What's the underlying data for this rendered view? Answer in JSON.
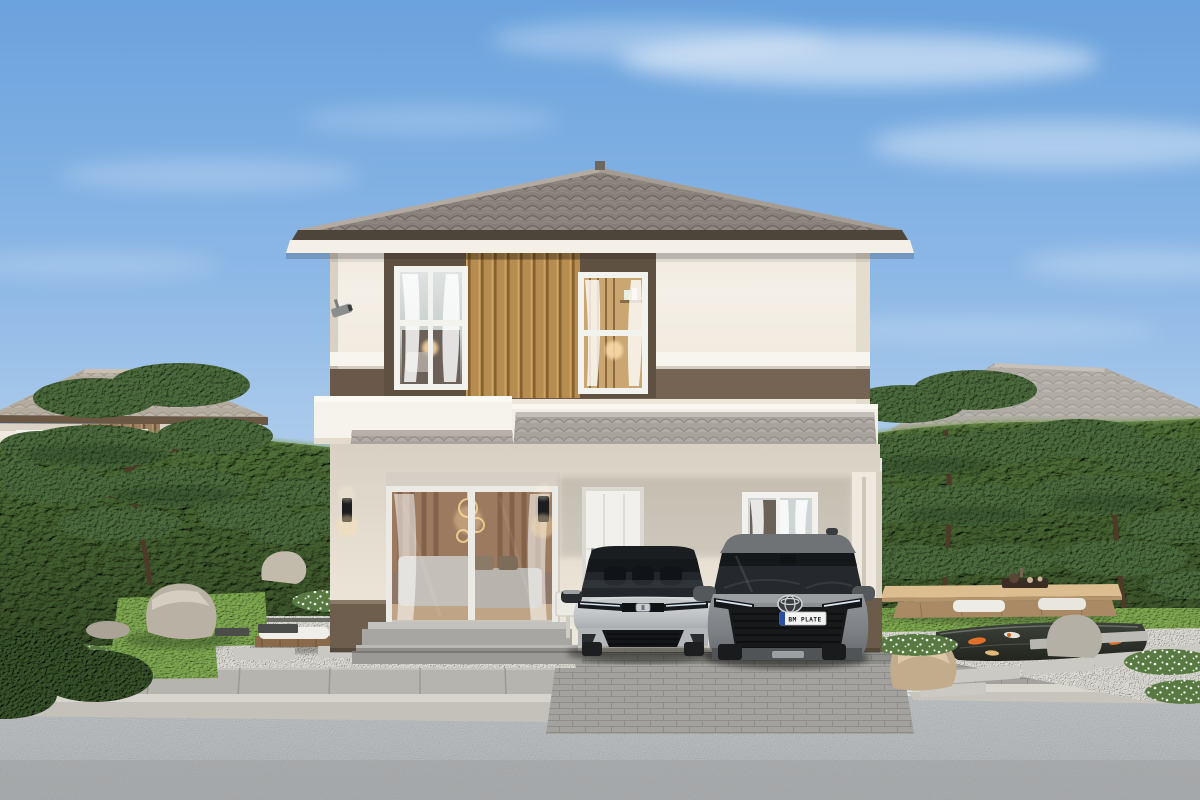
{
  "meta": {
    "title": "Photorealistic exterior rendering of a two-storey house at dusk",
    "view": "street-front elevation"
  },
  "palette": {
    "sky_top": "#6aa2dd",
    "sky_horizon": "#e9f1f7",
    "roof_tile": "#8f8881",
    "awning_tile": "#a8a39c",
    "fascia_dark": "#4a3f33",
    "wall_cream": "#f3eee5",
    "accent_brown_band": "#6a594a",
    "wood_slat_gold": "#b68c50",
    "hedge_green": "#4f7038",
    "pine_green": "#48683a",
    "grass_green": "#7aa34e",
    "gravel_white": "#d9d8d1",
    "paver_gray": "#a3a29e",
    "road_asphalt": "#b6b9bb",
    "sedan_silver": "#c9cbcd",
    "suv_gray": "#85888b",
    "pond_dark": "#2c302a",
    "koi_orange": "#e06f2a"
  },
  "scene": {
    "main_house": {
      "storeys": 2,
      "roof": "grey hip roof with ridge caps and deep eaves",
      "facade": "cream walls, dark brown horizontal band, central dark frame with golden wood-slat panel",
      "upper_windows": 2,
      "ground_floor": [
        "large sliding glass door to lit living room",
        "white entrance door",
        "single curtained window",
        "tiled carport awning on white pillar",
        "two black wall sconces",
        "security camera on left corner",
        "stone entry steps"
      ]
    },
    "vehicles": [
      {
        "label": "silver sedan",
        "position": "parked under carport, left"
      },
      {
        "label": "grey SUV",
        "position": "parked under carport, right"
      }
    ],
    "garden_left": [
      "clipped hedge",
      "niwaki pines",
      "boulders",
      "white gravel with paving slabs",
      "low bench with white cushion",
      "white ground-cover flowers",
      "dark shrubs"
    ],
    "garden_right": [
      "clipped hedge",
      "niwaki pines",
      "grass mound",
      "low wooden tea bench with cushions and tea tray",
      "koi pond with stepping slabs",
      "boulders",
      "white gravel",
      "white ground-cover flowers"
    ],
    "background": {
      "left_house": "single-storey neighbour, hip roof, wood-slat accents",
      "right_house": "neighbour house, hip roof, wood-slat accent band"
    },
    "foreground": [
      "slab sidewalk",
      "concrete kerb",
      "paver driveway apron",
      "asphalt road"
    ]
  },
  "license_plate": {
    "text": "BM PLATE"
  }
}
